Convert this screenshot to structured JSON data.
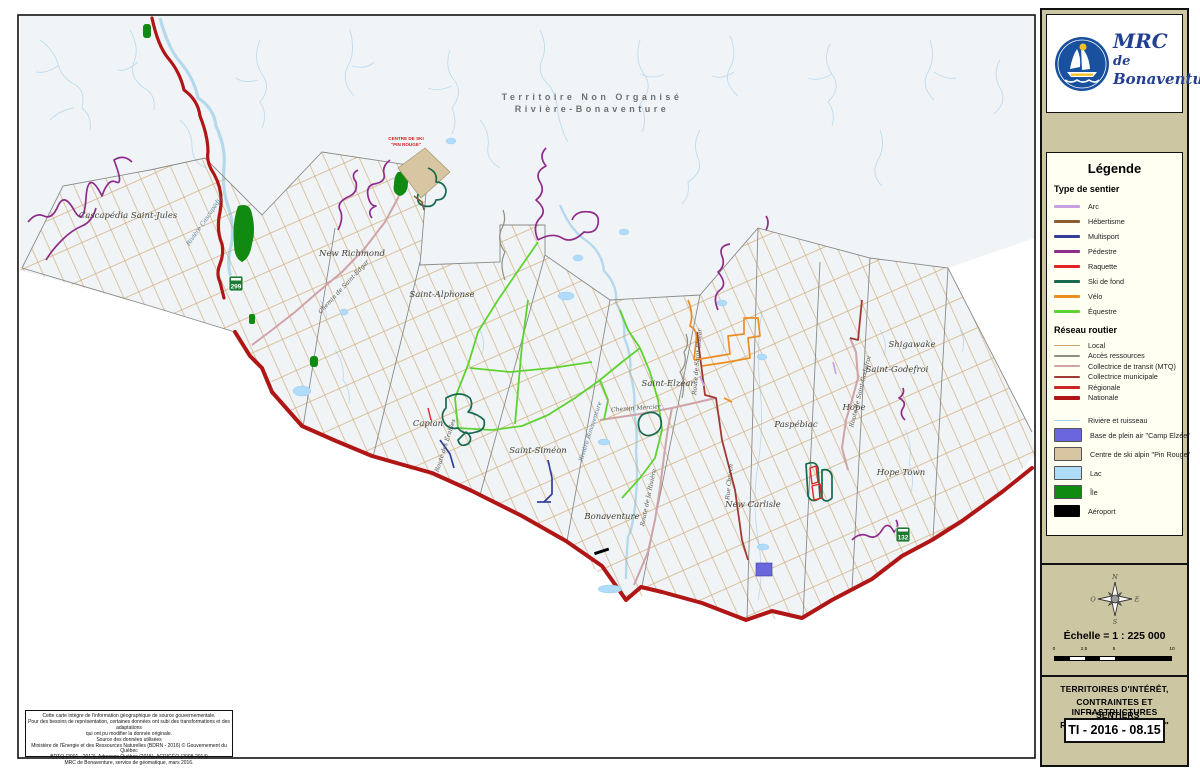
{
  "branding": {
    "org_name_1": "MRC",
    "org_name_2": "de",
    "org_name_3": "Bonaventure",
    "logo_colors": {
      "circle": "#19519f",
      "sun": "#f0c32a"
    }
  },
  "legend": {
    "title": "Légende",
    "trail_section_title": "Type de sentier",
    "trail_types": [
      {
        "label": "Arc",
        "color": "#c79fe2"
      },
      {
        "label": "Hébertisme",
        "color": "#8a5c30"
      },
      {
        "label": "Multisport",
        "color": "#333f99"
      },
      {
        "label": "Pédestre",
        "color": "#8e2c8a"
      },
      {
        "label": "Raquette",
        "color": "#e32222"
      },
      {
        "label": "Ski de fond",
        "color": "#186a4e"
      },
      {
        "label": "Vélo",
        "color": "#ee8d1f"
      },
      {
        "label": "Équestre",
        "color": "#5fd232"
      }
    ],
    "road_section_title": "Réseau routier",
    "road_types": [
      {
        "label": "Local",
        "color": "#c8a468"
      },
      {
        "label": "Accès ressources",
        "color": "#8f8f80"
      },
      {
        "label": "Collectrice de transit (MTQ)",
        "color": "#cfa3a8"
      },
      {
        "label": "Collectrice municipale",
        "color": "#a03a32"
      },
      {
        "label": "Régionale",
        "color": "#cd2626"
      },
      {
        "label": "Nationale",
        "color": "#b01616"
      }
    ],
    "water_line": {
      "label": "Rivière et ruisseau",
      "color": "#a9d3ec"
    },
    "areas": [
      {
        "label": "Base de plein air \"Camp Elzée\"",
        "color": "#6a66dd"
      },
      {
        "label": "Centre de ski alpin \"Pin Rouge\"",
        "color": "#d8c6a2"
      },
      {
        "label": "Lac",
        "color": "#aedcfa"
      },
      {
        "label": "Île",
        "color": "#108a10"
      },
      {
        "label": "Aéroport",
        "color": "#000000"
      }
    ]
  },
  "compass": {
    "n": "N",
    "e": "E",
    "s": "S",
    "w": "O"
  },
  "scale": {
    "label": "Échelle = 1 : 225 000",
    "ticks": [
      "0",
      "2,5",
      "5",
      "10"
    ]
  },
  "title_block": {
    "line1": "TERRITOIRES D'INTÉRÊT,",
    "line2": "CONTRAINTES ET INFRASTRUCTURES",
    "line3": "\" SENTIERS RÉCRÉOTOURISTIQUES \"",
    "code": "TI - 2016 - 08.15"
  },
  "attribution": {
    "lines": [
      "Cette carte intègre de l'information géographique de source gouvernementale.",
      "Pour des besoins de représentation, certaines données ont subi des transformations et des adaptations",
      "qui ont pu modifier la donnée originale.",
      "Source des données utilisées",
      "Ministère de l'Énergie et des Ressources Naturelles (BDRN - 2016) © Gouvernement du Québec",
      "BDTQ (2001 - 2012), Adresses Québec (2015), ACRIGÉO (2008-2014)",
      "MRC de Bonaventure, service de géomatique, mars 2016."
    ]
  },
  "map": {
    "territory_label_1": "Territoire Non Organisé",
    "territory_label_2": "Rivière-Bonaventure",
    "municipality_labels": [
      "Cascapédia Saint-Jules",
      "New Richmond",
      "Saint-Alphonse",
      "Caplan",
      "Saint-Siméon",
      "Saint-Elzéar",
      "Bonaventure",
      "New Carlisle",
      "Paspébiac",
      "Hope",
      "Hope Town",
      "Saint-Godefroi",
      "Shigawake"
    ],
    "road_labels": [
      "Chemin de Saint-Edgar",
      "Chemin Mercier",
      "Route de la Rivière",
      "Rue Church",
      "Route de Saint-Elzéar",
      "Route des Érables",
      "Route de Saint-Godefroi"
    ],
    "river_labels": [
      "Rivière Cascapédia",
      "Rivière Bonaventure"
    ],
    "poi_labels": {
      "ski_center_1": "CENTRE DE SKI",
      "ski_center_2": "\"PIN ROUGE\""
    },
    "route_shields": [
      "299",
      "132"
    ]
  }
}
